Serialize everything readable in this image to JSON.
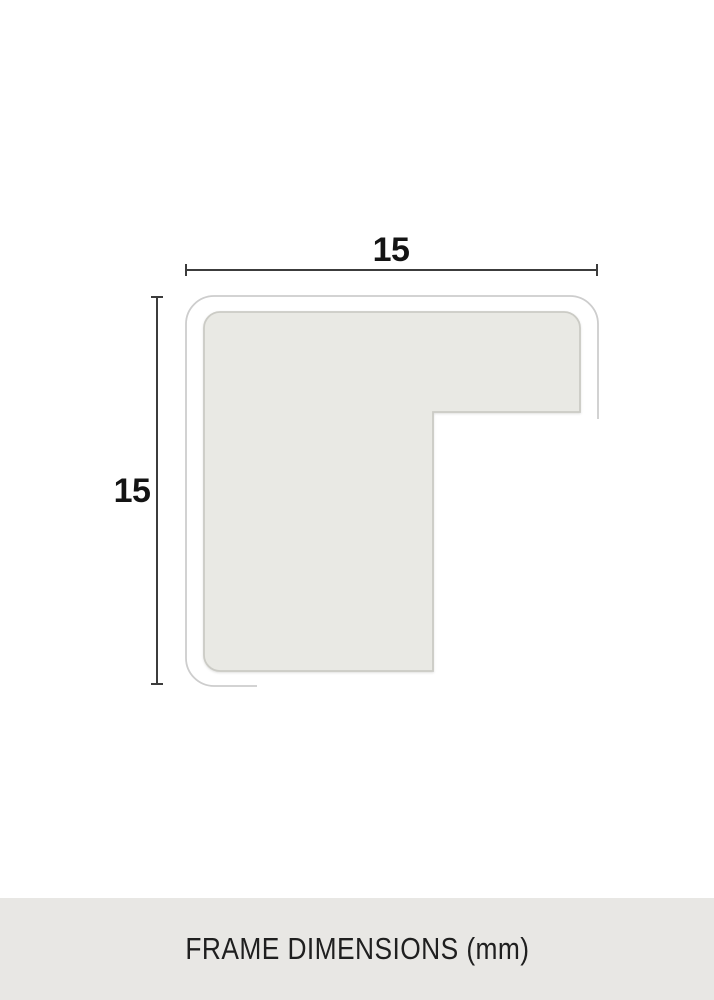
{
  "diagram": {
    "caption": "FRAME DIMENSIONS (mm)",
    "unit": "mm",
    "width_label": "15",
    "height_label": "15"
  },
  "colors": {
    "background": "#ffffff",
    "profile_fill": "#e9e9e4",
    "profile_stroke": "#cbcbc5",
    "outline_stroke": "#cdcdcd",
    "dimension_line": "#3c3c3c",
    "label_text": "#141414",
    "footer_background": "#e8e7e4",
    "footer_text": "#1f1f1f"
  }
}
